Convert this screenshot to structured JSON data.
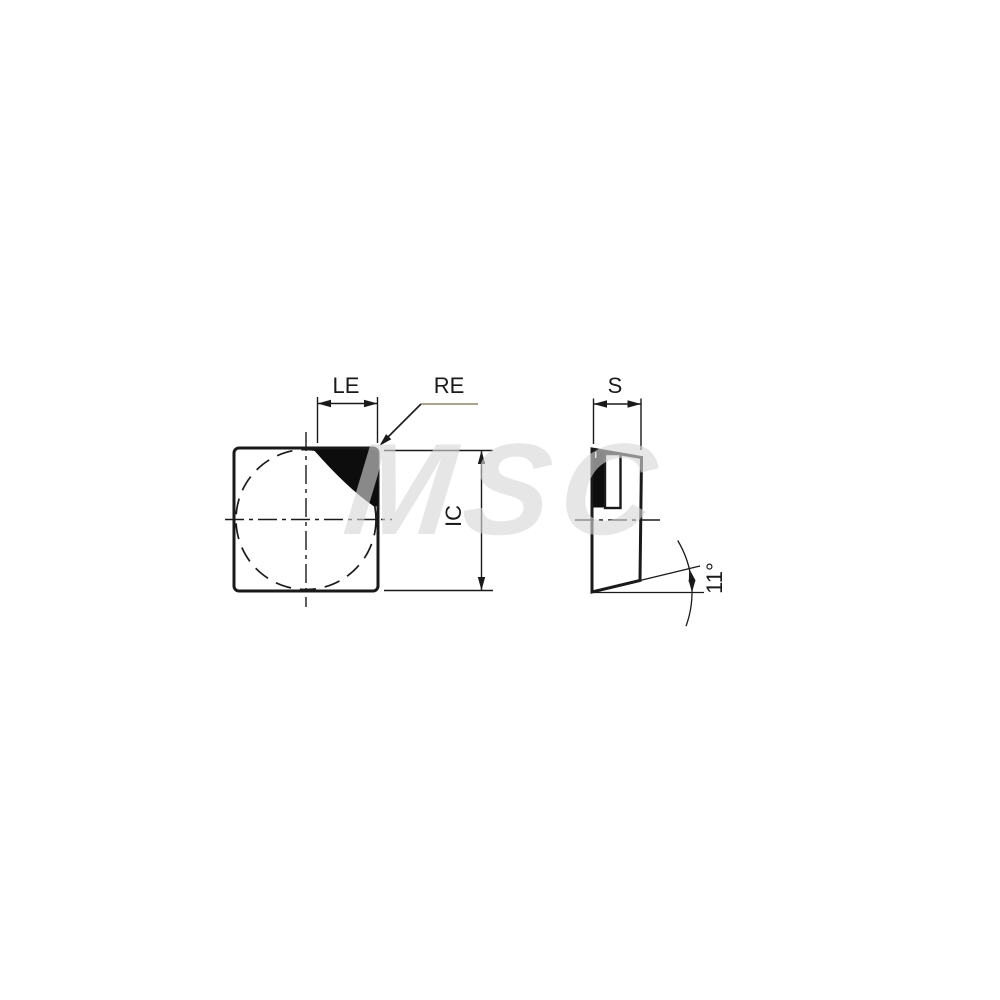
{
  "page": {
    "background": "#ffffff",
    "width": 1000,
    "height": 1000
  },
  "watermark": {
    "text": "MSC",
    "color": "rgba(214,214,214,0.62)"
  },
  "diagram": {
    "kind": "engineering-drawing",
    "labels": {
      "le": "LE",
      "re": "RE",
      "ic": "IC",
      "s": "S",
      "clearance_angle": "11°"
    },
    "colors": {
      "line": "#1a1a1a",
      "tip_fill": "#0d0d0d",
      "leader_accent": "#8d8568",
      "background": "#ffffff"
    }
  }
}
